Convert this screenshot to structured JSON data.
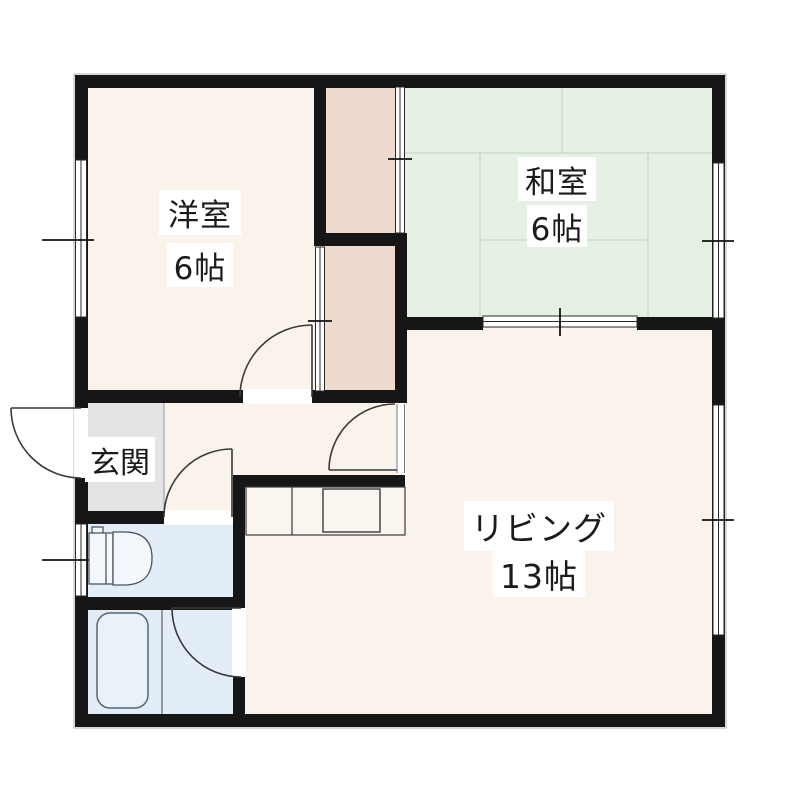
{
  "floor_plan": {
    "rooms": {
      "western": {
        "name": "洋室",
        "size": "6帖"
      },
      "japanese": {
        "name": "和室",
        "size": "6帖"
      },
      "living": {
        "name": "リビング",
        "size": "13帖"
      },
      "entrance": {
        "name": "玄関"
      }
    },
    "colors": {
      "wall": "#161616",
      "floor": "#f9f3eb",
      "tatami_room": "#e7f0e5",
      "tatami_grid_line": "#ccdccb",
      "closet": "#eedacc",
      "entrance_floor": "#e4e3e6",
      "wet_area": "#e3edf7",
      "label_text": "#1b1b1b"
    },
    "fixtures": [
      "toilet-icon",
      "bathtub-icon",
      "kitchen-counter-icon",
      "door-swing-arc",
      "sliding-door-symbol",
      "window-symbol"
    ]
  }
}
